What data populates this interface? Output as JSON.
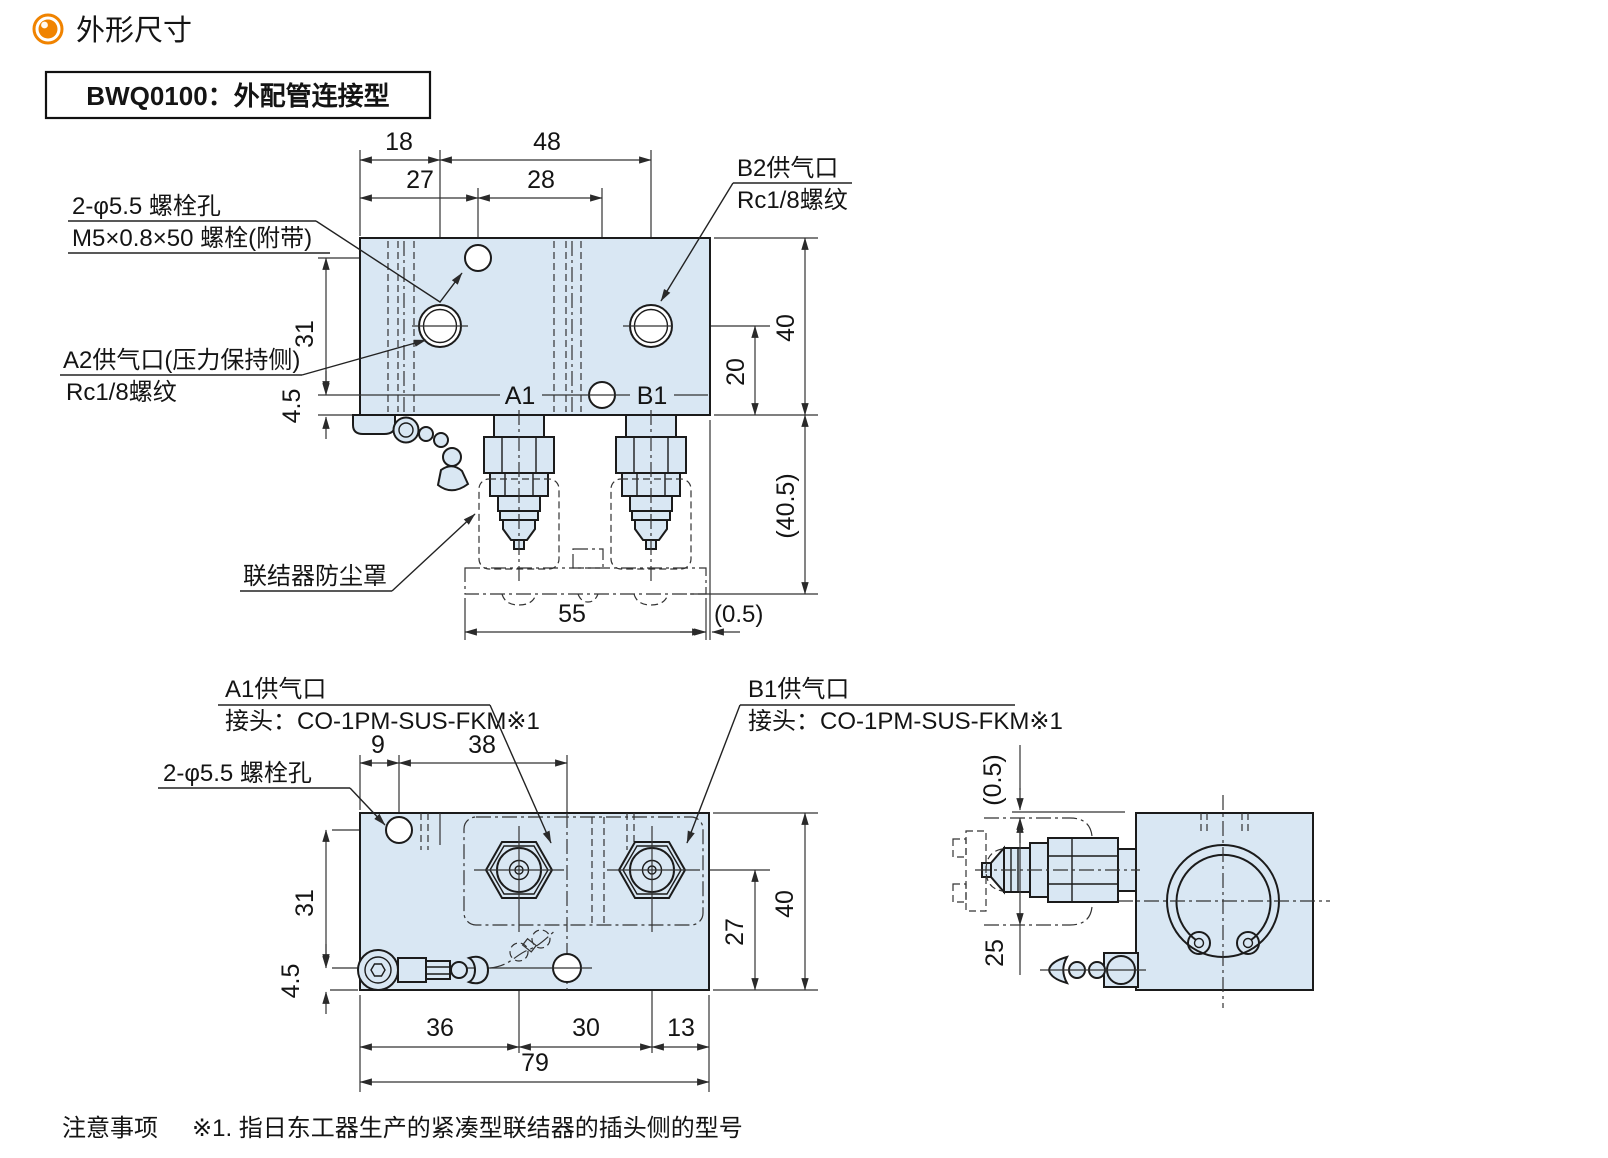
{
  "header": {
    "title": "外形尺寸",
    "model": "BWQ0100：外配管连接型"
  },
  "note": {
    "prefix": "注意事项",
    "body": "※1. 指日东工器生产的紧凑型联结器的插头侧的型号"
  },
  "colors": {
    "body_fill": "#d9e7f3",
    "line": "#1b1b1b",
    "accent": "#f08300"
  },
  "top": {
    "labels": {
      "bolt_l1": "2-φ5.5 螺栓孔",
      "bolt_l2": "M5×0.8×50 螺栓(附带)",
      "a2_l1": "A2供气口(压力保持侧)",
      "a2_l2": "Rc1/8螺纹",
      "b2_l1": "B2供气口",
      "b2_l2": "Rc1/8螺纹",
      "dust": "联结器防尘罩",
      "a1": "A1",
      "b1": "B1"
    },
    "dims": {
      "w18": "18",
      "w48": "48",
      "w27": "27",
      "w28": "28",
      "h31": "31",
      "h45": "4.5",
      "h40": "40",
      "h20": "20",
      "h405": "(40.5)",
      "w55": "55",
      "w05": "(0.5)"
    }
  },
  "bottom": {
    "labels": {
      "a1_l1": "A1供气口",
      "a1_l2": "接头：CO-1PM-SUS-FKM※1",
      "b1_l1": "B1供气口",
      "b1_l2": "接头：CO-1PM-SUS-FKM※1",
      "bolt": "2-φ5.5 螺栓孔"
    },
    "dims": {
      "w9": "9",
      "w38": "38",
      "h31": "31",
      "h45": "4.5",
      "w36": "36",
      "w30": "30",
      "w13": "13",
      "w79": "79",
      "h27": "27",
      "h40": "40"
    }
  },
  "side": {
    "dims": {
      "h05": "(0.5)",
      "h25": "25"
    }
  }
}
